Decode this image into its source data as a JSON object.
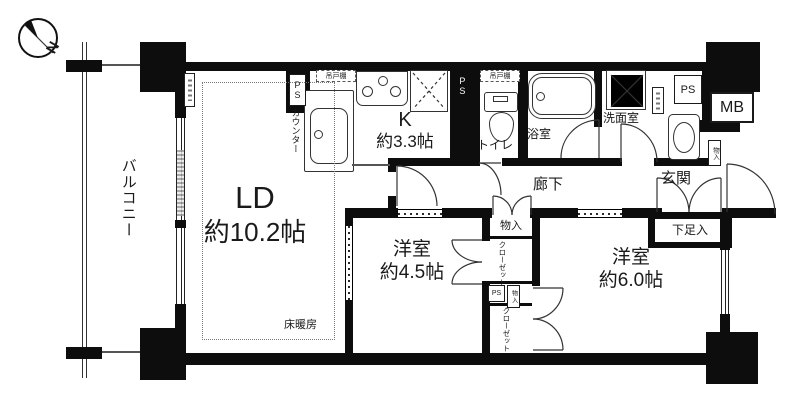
{
  "compass": {
    "north": "N"
  },
  "balcony": {
    "label": "バルコニー"
  },
  "living": {
    "name": "LD",
    "size": "約10.2帖",
    "floor_heating": "床暖房"
  },
  "kitchen": {
    "name": "K",
    "size": "約3.3帖",
    "counter": "カウンター",
    "hanging_cupboard": "吊戸棚",
    "ps_left": "PS",
    "ps_right": "PS"
  },
  "toilet": {
    "label": "トイレ",
    "hanging_cupboard": "吊戸棚"
  },
  "bathroom": {
    "label": "浴室"
  },
  "washroom": {
    "label": "洗面室",
    "ps": "PS",
    "meter_box": "MB"
  },
  "hallway": {
    "label": "廊下",
    "storage": "物入"
  },
  "entrance": {
    "label": "玄関",
    "shoe_cabinet": "下足入",
    "storage": "物入"
  },
  "bedroom_small": {
    "name": "洋室",
    "size": "約4.5帖",
    "closet": "クローゼット"
  },
  "bedroom_large": {
    "name": "洋室",
    "size": "約6.0帖",
    "closet": "クローゼット",
    "ps": "PS",
    "storage": "物入"
  }
}
